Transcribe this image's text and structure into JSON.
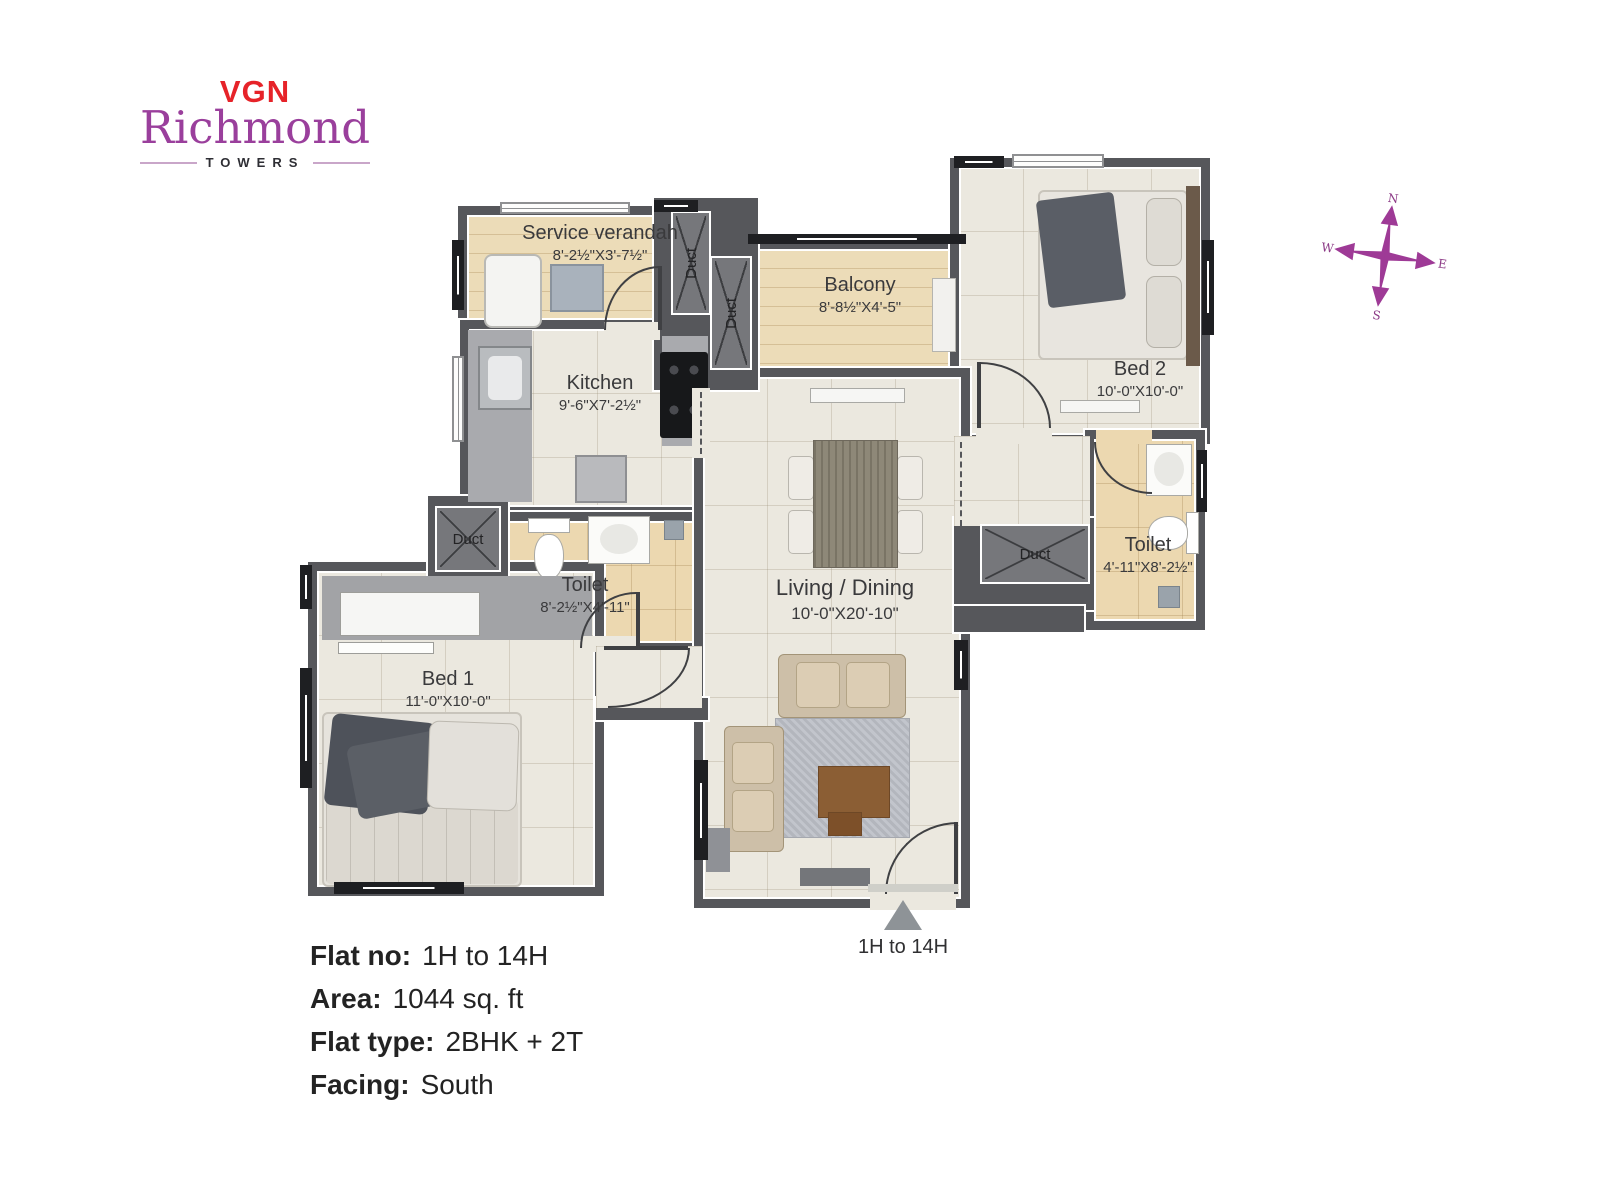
{
  "logo": {
    "vgn": "VGN",
    "richmond": "Richmond",
    "towers": "TOWERS"
  },
  "compass": {
    "north": "N",
    "east": "E",
    "south": "S",
    "west": "W"
  },
  "plan": {
    "rooms": {
      "service_verandah": {
        "name": "Service verandah",
        "dims": "8'-2½\"X3'-7½\""
      },
      "balcony": {
        "name": "Balcony",
        "dims": "8'-8½\"X4'-5\""
      },
      "bed2": {
        "name": "Bed 2",
        "dims": "10'-0\"X10'-0\""
      },
      "kitchen": {
        "name": "Kitchen",
        "dims": "9'-6\"X7'-2½\""
      },
      "toilet1": {
        "name": "Toilet",
        "dims": "8'-2½\"X4'-11\""
      },
      "living_dining": {
        "name": "Living / Dining",
        "dims": "10'-0\"X20'-10\""
      },
      "toilet2": {
        "name": "Toilet",
        "dims": "4'-11\"X8'-2½\""
      },
      "bed1": {
        "name": "Bed 1",
        "dims": "11'-0\"X10'-0\""
      }
    },
    "duct_label": "Duct",
    "entrance_label": "1H to 14H"
  },
  "info": {
    "rows": [
      {
        "label": "Flat no:",
        "value": "1H to 14H"
      },
      {
        "label": "Area:",
        "value": "1044 sq. ft"
      },
      {
        "label": "Flat type:",
        "value": "2BHK + 2T"
      },
      {
        "label": "Facing:",
        "value": "South"
      }
    ]
  },
  "colors": {
    "brand_red": "#e62329",
    "brand_purple": "#9a3f9c",
    "compass_purple": "#9e3a96",
    "wall_gray": "#56575b"
  }
}
